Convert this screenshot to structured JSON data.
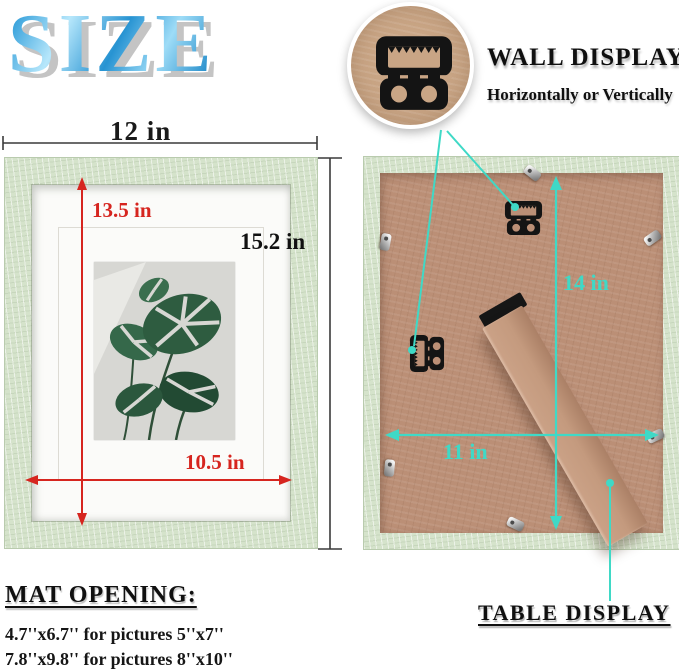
{
  "page_title": "SIZE",
  "wall_display": {
    "title": "WALL DISPLAY",
    "subtitle": "Horizontally or Vertically"
  },
  "table_display": {
    "title": "TABLE DISPLAY"
  },
  "front_view": {
    "outer_width_label": "12 in",
    "outer_height_label": "15.2 in",
    "mat_height_label": "13.5 in",
    "mat_width_label": "10.5 in"
  },
  "back_view": {
    "board_height_label": "14 in",
    "board_width_label": "11 in"
  },
  "mat_opening": {
    "title": "MAT OPENING:",
    "lines": [
      "4.7''x6.7'' for pictures 5''x7''",
      "7.8''x9.8'' for pictures 8''x10''"
    ]
  },
  "icons": {
    "wall_hanger": "sawtooth-hanger-icon",
    "hardware_clip": "metal-clip-icon",
    "stand": "easel-stand"
  },
  "colors": {
    "title_blue": "#2796d4",
    "frame_green": "#d5e3cb",
    "mat_white": "#fbfbf9",
    "kraft_brown": "#bb8f76",
    "callout_kraft": "#c9a585",
    "accent_red": "#d6251f",
    "accent_teal": "#3fd9c6",
    "text_black": "#111111"
  }
}
